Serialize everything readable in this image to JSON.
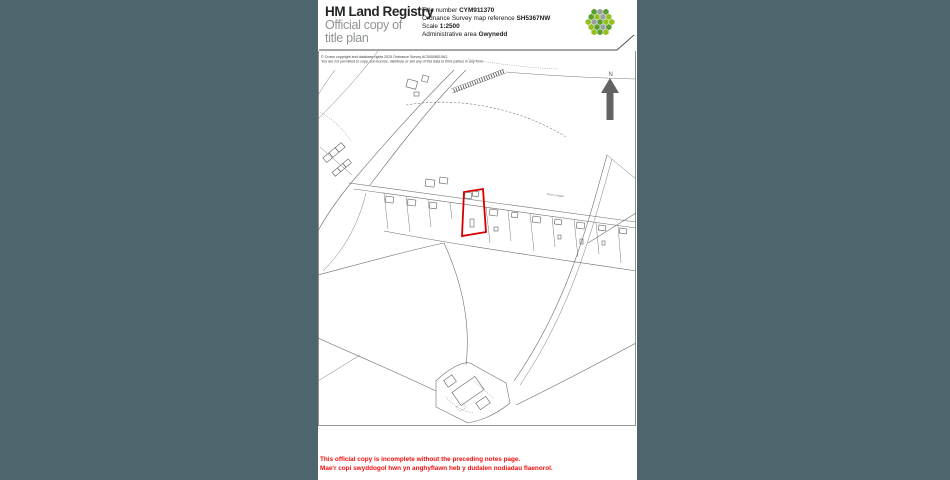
{
  "background_color": "#4d656c",
  "header": {
    "brand": "HM Land Registry",
    "subtitle_line1": "Official copy of",
    "subtitle_line2": "title plan",
    "fields": [
      {
        "label": "Title number ",
        "value": "CYM911370"
      },
      {
        "label": "Ordnance Survey map reference ",
        "value": "SH5367NW"
      },
      {
        "label": "Scale ",
        "value": "1:2500"
      },
      {
        "label": "Administrative area ",
        "value": "Gwynedd"
      }
    ],
    "logo": {
      "name": "hm-land-registry-hex-logo",
      "radius": 3.1,
      "cells": [
        {
          "x": 16,
          "y": 16,
          "c": "#5a9e30"
        },
        {
          "x": 21.9,
          "y": 16,
          "c": "#94c01f"
        },
        {
          "x": 18.95,
          "y": 21.1,
          "c": "#9aa0a0"
        },
        {
          "x": 13.05,
          "y": 21.1,
          "c": "#5a9e30"
        },
        {
          "x": 10.1,
          "y": 16,
          "c": "#9aa0a0"
        },
        {
          "x": 13.05,
          "y": 10.9,
          "c": "#94c01f"
        },
        {
          "x": 18.95,
          "y": 10.9,
          "c": "#9aa0a0"
        },
        {
          "x": 10.1,
          "y": 5.8,
          "c": "#5a9e30"
        },
        {
          "x": 16,
          "y": 5.8,
          "c": "#9aa0a0"
        },
        {
          "x": 21.9,
          "y": 5.8,
          "c": "#5a9e30"
        },
        {
          "x": 24.8,
          "y": 10.9,
          "c": "#94c01f"
        },
        {
          "x": 27.8,
          "y": 16,
          "c": "#94c01f"
        },
        {
          "x": 24.8,
          "y": 21.1,
          "c": "#5a9e30"
        },
        {
          "x": 21.9,
          "y": 26.2,
          "c": "#94c01f"
        },
        {
          "x": 16,
          "y": 26.2,
          "c": "#5a9e30"
        },
        {
          "x": 10.1,
          "y": 26.2,
          "c": "#94c01f"
        },
        {
          "x": 7.2,
          "y": 21.1,
          "c": "#94c01f"
        },
        {
          "x": 4.2,
          "y": 16,
          "c": "#94c01f"
        },
        {
          "x": 7.2,
          "y": 10.9,
          "c": "#5a9e30"
        }
      ]
    }
  },
  "map": {
    "copyright_line1": "© Crown copyright and database rights 2025 Ordnance Survey AC0000851063.",
    "copyright_line2": "You are not permitted to copy, sub-license, distribute or sell any of this data to third parties in any form.",
    "north_label": "N",
    "road_label": "Bron y Waen",
    "parcel_outline_color": "#d40000",
    "line_color": "#6e6e6e"
  },
  "footer": {
    "line1_en": "This official copy is incomplete without the preceding notes page.",
    "line2_cy": "Mae'r copi swyddogol hwn yn anghyflawn heb y dudalen nodiadau flaenorol.",
    "color": "#f20d0d"
  }
}
